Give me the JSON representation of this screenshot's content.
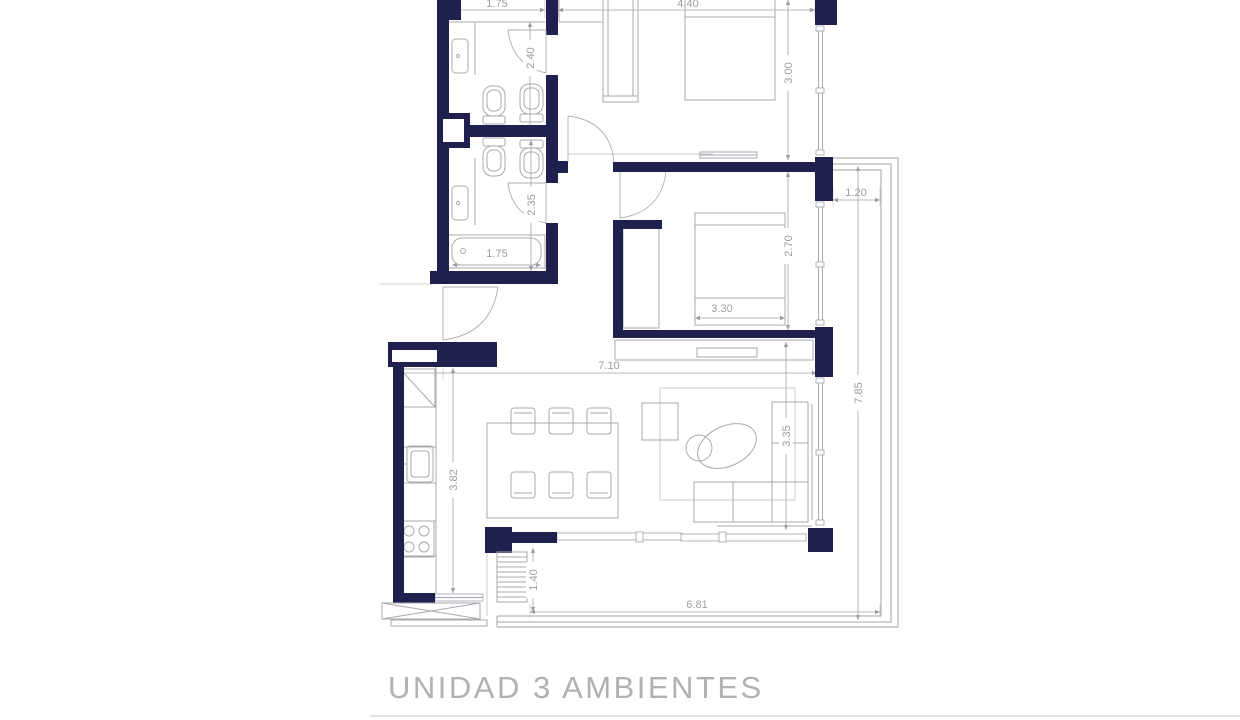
{
  "title": "UNIDAD 3 AMBIENTES",
  "colors": {
    "wall": "#20204e",
    "furniture_line": "#a9a9b0",
    "dimension_text": "#9c9ca4",
    "title_text": "#b1b1b3",
    "rule": "#dcdce0"
  },
  "dimensions": {
    "bathroom_top_width": "1.75",
    "bedroom1_width": "4.40",
    "bathroom1_depth": "2.40",
    "bedroom1_depth": "3.00",
    "balcony_side_width": "1.20",
    "bathroom2_depth": "2.35",
    "bathtub_length": "1.75",
    "bedroom2_depth": "2.70",
    "bedroom2_bed_width": "3.30",
    "living_width": "7.10",
    "kitchen_length": "3.82",
    "living_depth": "3.35",
    "balcony_length": "7.85",
    "stairs_width": "1.40",
    "terrace_length": "6.81"
  }
}
